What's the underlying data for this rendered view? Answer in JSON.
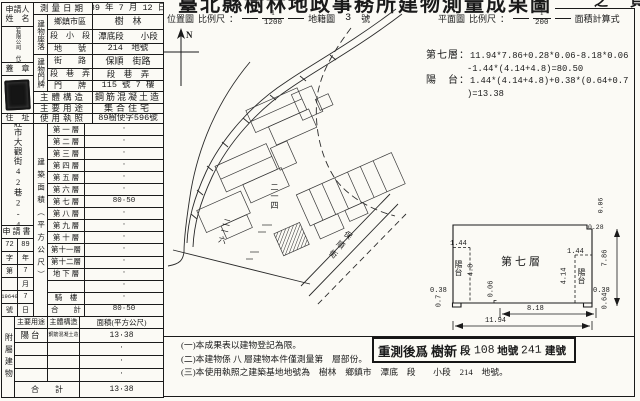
{
  "title": {
    "main": "臺北縣樹林地政事務所建物測量成果圖",
    "page_suffix": "之　頁"
  },
  "location_map": {
    "label": "位置圖",
    "scale_label": "比例尺",
    "colon": "：",
    "frac_num": "1",
    "frac_den": "1200",
    "ref": "地籍圖",
    "sheet_no": "3",
    "sheet_unit": "號",
    "north": "N"
  },
  "plan_map": {
    "label": "平面圖",
    "scale_label": "比例尺",
    "colon": "：",
    "frac_num": "1",
    "frac_den": "200",
    "calc_title": "面積計算式"
  },
  "calc": {
    "l1_label": "第七層：",
    "l1": "11.94*7.86+0.28*0.06-8.18*0.06",
    "l2": "-1.44*(4.14+4.8)=80.50",
    "l3_label": "陽　台：",
    "l3": "1.44*(4.14+4.8)+0.38*(0.64+0.7",
    "l4": ")=13.38"
  },
  "applicant": {
    "header_line1": "申請人",
    "header_line2": "姓　名",
    "name": "銘騰建設股份有限公司　代表人：陳敏雄",
    "seal_label": "蓋　章",
    "address_label": "住　址",
    "address": "新莊市大觀街42巷2-4號"
  },
  "survey": {
    "date_label": "測量日期",
    "date": "89 年 7 月 12 日"
  },
  "situs": {
    "group_label": "建物座落",
    "rows": [
      {
        "label": "鄉鎮市區",
        "value": "樹　林"
      },
      {
        "label": "段　小　段",
        "value": "潭底段　　小段"
      },
      {
        "label": "地　　號",
        "value": "214　地號"
      }
    ]
  },
  "doorplate": {
    "group_label": "建物門牌",
    "rows": [
      {
        "label": "街　　路",
        "value": "保順　街路"
      },
      {
        "label": "段　巷　弄",
        "value": "段　巷　弄"
      },
      {
        "label": "門　　牌",
        "value": "115 號 7 樓"
      }
    ]
  },
  "structure": {
    "label": "主體構造",
    "value": "鋼筋混凝土造"
  },
  "usage": {
    "label": "主要用途",
    "value": "集合住宅"
  },
  "license": {
    "label": "使用執照",
    "value": "89樹使字596號"
  },
  "application": {
    "header": "申請書",
    "pairs": [
      [
        "72",
        "89"
      ],
      [
        "字",
        "年"
      ],
      [
        "第",
        "7"
      ],
      [
        "",
        "月"
      ],
      [
        "19640",
        "7"
      ],
      [
        "號",
        "日"
      ]
    ]
  },
  "floor_area": {
    "band_label": "建築面積（平方公尺）",
    "rows": [
      {
        "label": "第 一 層",
        "value": "·"
      },
      {
        "label": "第 二 層",
        "value": "·"
      },
      {
        "label": "第 三 層",
        "value": "·"
      },
      {
        "label": "第 四 層",
        "value": "·"
      },
      {
        "label": "第 五 層",
        "value": "·"
      },
      {
        "label": "第 六 層",
        "value": "·"
      },
      {
        "label": "第 七 層",
        "value": "80·50"
      },
      {
        "label": "第 八 層",
        "value": "·"
      },
      {
        "label": "第 九 層",
        "value": "·"
      },
      {
        "label": "第 十 層",
        "value": "·"
      },
      {
        "label": "第十一層",
        "value": "·"
      },
      {
        "label": "第十二層",
        "value": "·"
      },
      {
        "label": "地 下 層",
        "value": "·"
      },
      {
        "label": "",
        "value": "·"
      },
      {
        "label": "騎　樓",
        "value": "·"
      },
      {
        "label": "合　　計",
        "value": "80·50"
      }
    ]
  },
  "annex": {
    "band_label": "附屬建物",
    "headers": [
      "主要用途",
      "主體構造",
      "面積(平方公尺)"
    ],
    "rows": [
      {
        "use": "陽台",
        "struct": "鋼筋混凝土造",
        "area": "13·38"
      },
      {
        "use": "",
        "struct": "",
        "area": "·"
      },
      {
        "use": "",
        "struct": "",
        "area": "·"
      },
      {
        "use": "",
        "struct": "",
        "area": "·"
      }
    ],
    "total_label": "合　　計",
    "total_value": "13·38"
  },
  "map_labels": {
    "parcel_main": "二一四",
    "parcel_side": "二一六",
    "street": "保順街"
  },
  "plan": {
    "floor_label": "第七層",
    "balcony_label": "陽台",
    "dims": {
      "w_total": "11.94",
      "w_inner": "8.18",
      "h_total": "7.86",
      "bal_l_w": "1.44",
      "bal_l_h": "4.8",
      "bal_r_w": "1.44",
      "bal_r_h": "4.14",
      "step_l": "0.38",
      "step_l_w": "0.7",
      "step_r": "0.38",
      "step_r_w": "0.64",
      "notch_top": "0.28",
      "notch_top_d": "0.06",
      "notch_bottom": "0.06"
    }
  },
  "stamp": {
    "prefix": "重測後爲",
    "section": "樹新",
    "section_unit": "段",
    "parcel": "108",
    "parcel_unit": "地號",
    "bldg_no": "241",
    "bldg_unit": "建號"
  },
  "notes": [
    "(一)本成果表以建物登記為限。",
    "(二)本建物係 八 層建物本件僅測量第　層部份。",
    "(三)本使用執照之建築基地地號為　樹林　鄉鎮市　潭底　段　　小段　214　地號。"
  ]
}
